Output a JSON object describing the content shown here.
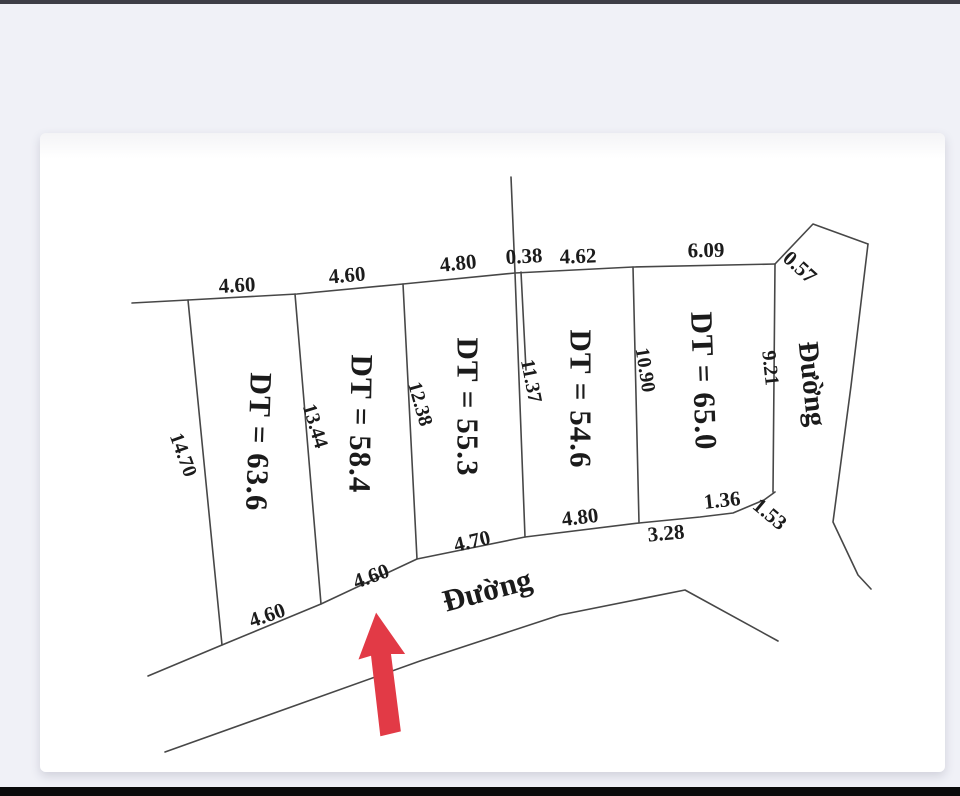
{
  "window": {
    "background_color": "#f0f1f7",
    "top_edge_color": "#3e3e46",
    "bottom_edge_color": "#0a0a0b",
    "card_color": "#ffffff"
  },
  "diagram": {
    "ink_color": "#474747",
    "arrow_color": "#e23a46",
    "labels": {
      "top": [
        "4.60",
        "4.60",
        "4.80",
        "0.38",
        "4.62",
        "6.09",
        "0.57"
      ],
      "sides": [
        "14.70",
        "13.44",
        "12.38",
        "11.37",
        "10.90",
        "9.21"
      ],
      "areas": [
        "DT = 63.6",
        "DT = 58.4",
        "DT = 55.3",
        "DT = 54.6",
        "DT = 65.0"
      ],
      "bottom": [
        "4.60",
        "4.60",
        "4.70",
        "4.80",
        "3.28",
        "1.36",
        "1.53"
      ],
      "road_bottom": "Đường",
      "road_right": "Đường"
    }
  }
}
